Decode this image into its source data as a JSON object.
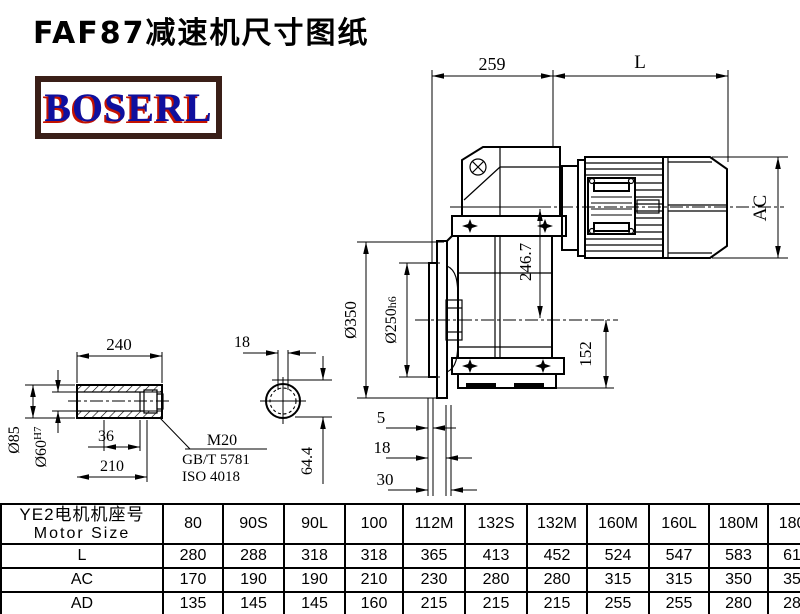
{
  "title": "FAF87减速机尺寸图纸",
  "logo": {
    "text": "BOSERL"
  },
  "drawing": {
    "dims": {
      "width_259": "259",
      "length_L": "L",
      "motor_dia_AC": "AC",
      "flange_od": "Ø350",
      "spigot_dia": "Ø250",
      "spigot_tol": "h6",
      "axis_height": "246.7",
      "base_to_axis": "152",
      "face_offset_5": "5",
      "face_offset_18": "18",
      "face_offset_30": "30",
      "shaft_length": "240",
      "hub_length": "210",
      "slot_length": "36",
      "shaft_od": "Ø85",
      "bore_dia": "Ø60",
      "bore_tol": "H7",
      "keyway_width": "18",
      "keyway_height": "64.4"
    },
    "callout": {
      "line1": "M20",
      "line2": "GB/T 5781",
      "line3": "ISO 4018"
    }
  },
  "table": {
    "header_cn": "YE2电机机座号",
    "header_en": "Motor Size",
    "columns": [
      "80",
      "90S",
      "90L",
      "100",
      "112M",
      "132S",
      "132M",
      "160M",
      "160L",
      "180M",
      "180L"
    ],
    "rows": [
      {
        "label": "L",
        "values": [
          "280",
          "288",
          "318",
          "318",
          "365",
          "413",
          "452",
          "524",
          "547",
          "583",
          "616"
        ]
      },
      {
        "label": "AC",
        "values": [
          "170",
          "190",
          "190",
          "210",
          "230",
          "280",
          "280",
          "315",
          "315",
          "350",
          "350"
        ]
      },
      {
        "label": "AD",
        "values": [
          "135",
          "145",
          "145",
          "160",
          "215",
          "215",
          "215",
          "255",
          "255",
          "280",
          "280"
        ]
      }
    ]
  }
}
